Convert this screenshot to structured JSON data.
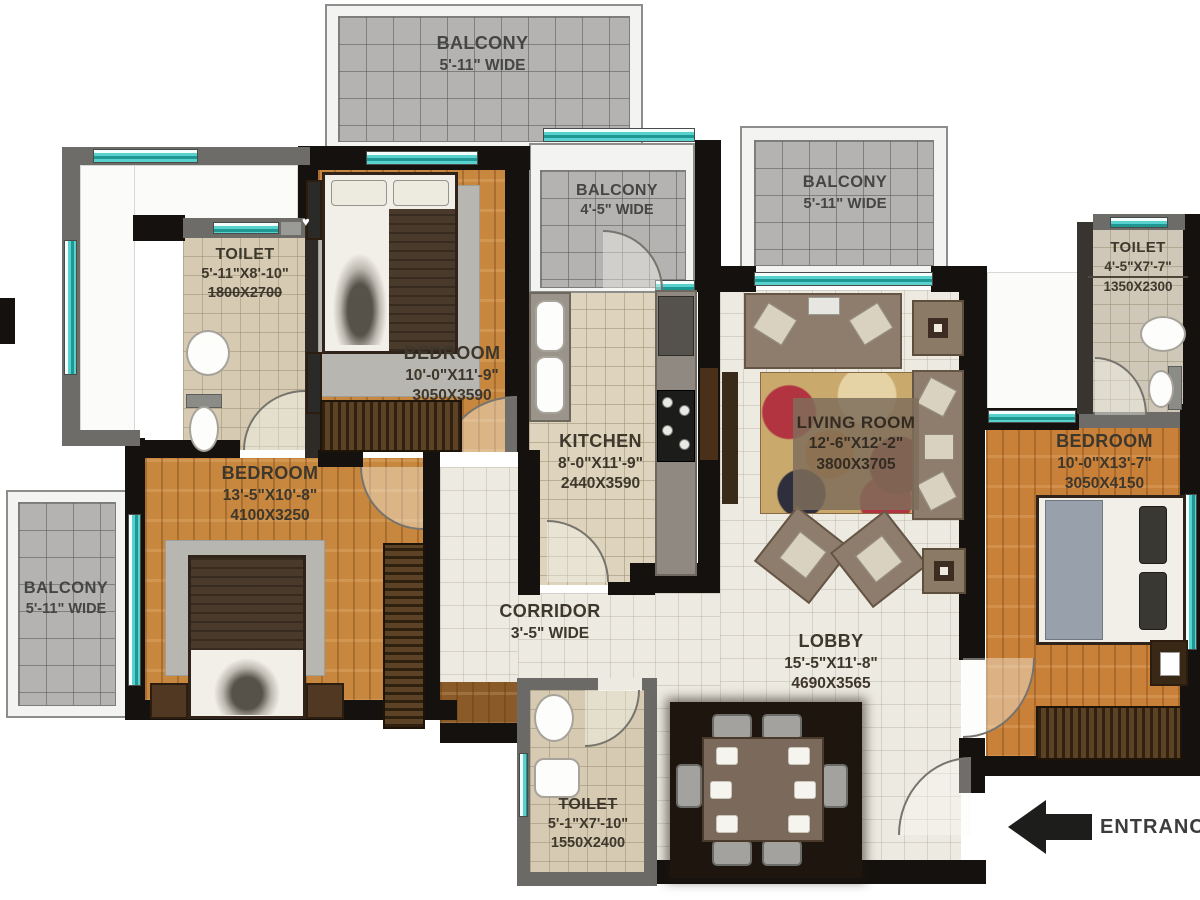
{
  "plan": {
    "rooms": {
      "balcony_top_left": {
        "name": "BALCONY",
        "size": "5'-11\" WIDE"
      },
      "balcony_top_mid": {
        "name": "BALCONY",
        "size": "4'-5\" WIDE"
      },
      "balcony_top_right": {
        "name": "BALCONY",
        "size": "5'-11\" WIDE"
      },
      "balcony_left": {
        "name": "BALCONY",
        "size": "5'-11\" WIDE"
      },
      "toilet_top_left": {
        "name": "TOILET",
        "size": "5'-11\"X8'-10\"",
        "metric": "1800X2700"
      },
      "bedroom_top": {
        "name": "BEDROOM",
        "size": "10'-0\"X11'-9\"",
        "metric": "3050X3590"
      },
      "bedroom_left": {
        "name": "BEDROOM",
        "size": "13'-5\"X10'-8\"",
        "metric": "4100X3250"
      },
      "bedroom_right": {
        "name": "BEDROOM",
        "size": "10'-0\"X13'-7\"",
        "metric": "3050X4150"
      },
      "kitchen": {
        "name": "KITCHEN",
        "size": "8'-0\"X11'-9\"",
        "metric": "2440X3590"
      },
      "living_room": {
        "name": "LIVING ROOM",
        "size": "12'-6\"X12'-2\"",
        "metric": "3800X3705"
      },
      "corridor": {
        "name": "CORRIDOR",
        "size": "3'-5\" WIDE"
      },
      "lobby": {
        "name": "LOBBY",
        "size": "15'-5\"X11'-8\"",
        "metric": "4690X3565"
      },
      "toilet_right": {
        "name": "TOILET",
        "size": "4'-5\"X7'-7\"",
        "metric": "1350X2300"
      },
      "toilet_bottom": {
        "name": "TOILET",
        "size": "5'-1\"X7'-10\"",
        "metric": "1550X2400"
      }
    },
    "entrance_label": "ENTRANCE",
    "icons": {
      "heart": "♥"
    },
    "colors": {
      "wall": "#14110e",
      "wood": "#c8873f",
      "tile": "#d6cbb2",
      "cream": "#edeae1",
      "balcony": "#b4b3b1",
      "window": "#57d2ce"
    }
  }
}
